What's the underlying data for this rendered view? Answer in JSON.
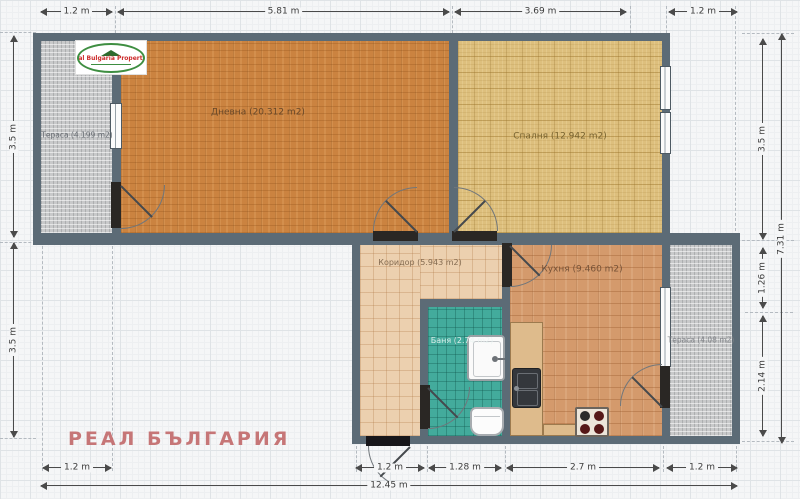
{
  "watermark": {
    "text": "РЕАЛ БЪЛГАРИЯ",
    "color": "#c2696a"
  },
  "logo": {
    "title": "Real Bulgaria Properties"
  },
  "rooms": {
    "terrace_left": {
      "label": "Тераса (4.199 m2)"
    },
    "living": {
      "label": "Дневна (20.312 m2)"
    },
    "bedroom": {
      "label": "Спалня (12.942 m2)"
    },
    "corridor": {
      "label": "Коридор (5.943 m2)"
    },
    "bath": {
      "label": "Баня (2.74 m2)"
    },
    "kitchen": {
      "label": "Кухня (9.460 m2)"
    },
    "terrace_right": {
      "label": "Тераса (4.08 m2)"
    }
  },
  "dimensions": {
    "top": {
      "terrace_left": "1.2 m",
      "living": "5.81 m",
      "bedroom": "3.69 m",
      "terrace_right": "1.2 m"
    },
    "bottom": {
      "terrace_left": "1.2 m",
      "entrance": "1.2 m",
      "bath": "1.28 m",
      "kitchen": "2.7 m",
      "terrace_right": "1.2 m",
      "total": "12.45 m"
    },
    "left": {
      "upper": "3.5 m",
      "lower": "3.5 m"
    },
    "right": {
      "upper": "3.5 m",
      "middle": "1.26 m",
      "lower": "2.14 m",
      "total": "7.31 m"
    }
  },
  "colors": {
    "wall": "#5c6b76",
    "living_floor": "#cb8340",
    "bedroom_floor": "#ddbf7d",
    "corridor_floor": "#ecd0af",
    "bath_floor": "#43ab9c",
    "kitchen_floor": "#d49a6c",
    "terrace_floor": "#c8c9ca",
    "dimension_text": "#3c3c3c",
    "watermark": "#c2696a"
  }
}
